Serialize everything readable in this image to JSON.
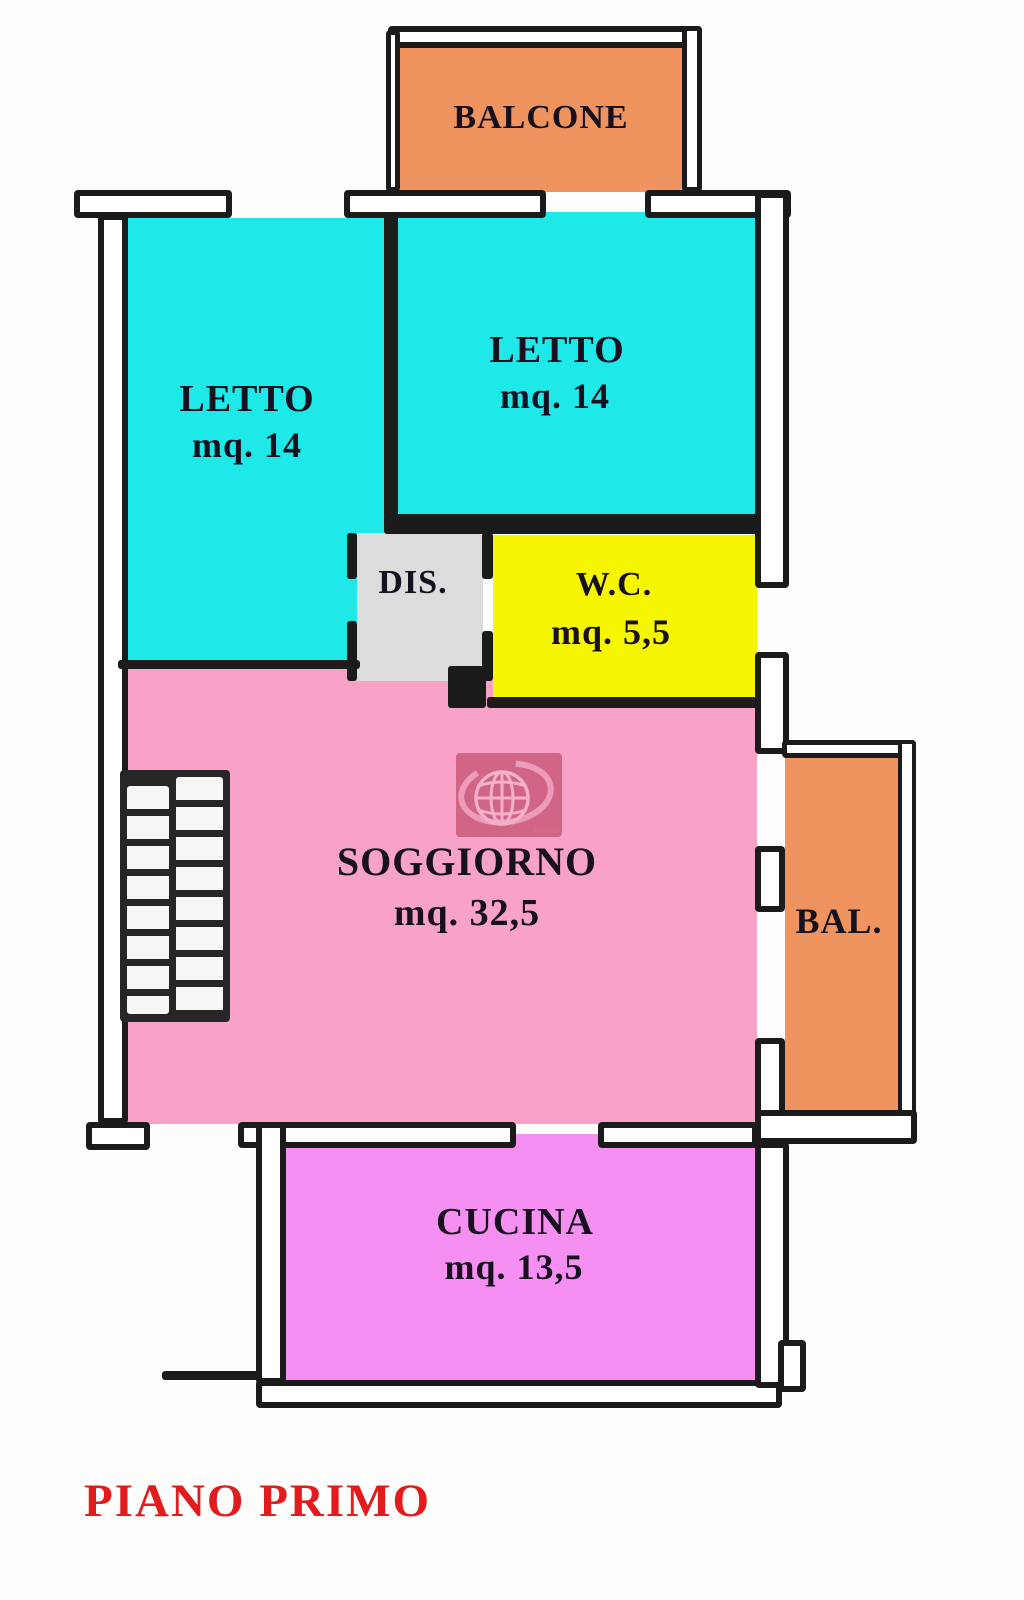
{
  "title": "PIANO PRIMO",
  "title_color": "#e21c1c",
  "wall_color": "#1b1b1b",
  "rooms": [
    {
      "key": "balcone",
      "label": "BALCONE",
      "area": "",
      "color": "#F0945F"
    },
    {
      "key": "letto-nw",
      "label": "LETTO",
      "area": "mq. 14",
      "color": "#1FE8E8"
    },
    {
      "key": "letto-ne",
      "label": "LETTO",
      "area": "mq. 14",
      "color": "#1FE8E8"
    },
    {
      "key": "dis",
      "label": "DIS.",
      "area": "",
      "color": "#DCDCDC"
    },
    {
      "key": "wc",
      "label": "W.C.",
      "area": "mq. 5,5",
      "color": "#F6F600"
    },
    {
      "key": "soggiorno",
      "label": "SOGGIORNO",
      "area": "mq. 32,5",
      "color": "#F8A2C8"
    },
    {
      "key": "bal",
      "label": "BAL.",
      "area": "",
      "color": "#F0945F"
    },
    {
      "key": "cucina",
      "label": "CUCINA",
      "area": "mq. 13,5",
      "color": "#F590F2"
    }
  ],
  "watermark": {
    "text": "GLOBO",
    "color": "#a72440"
  }
}
